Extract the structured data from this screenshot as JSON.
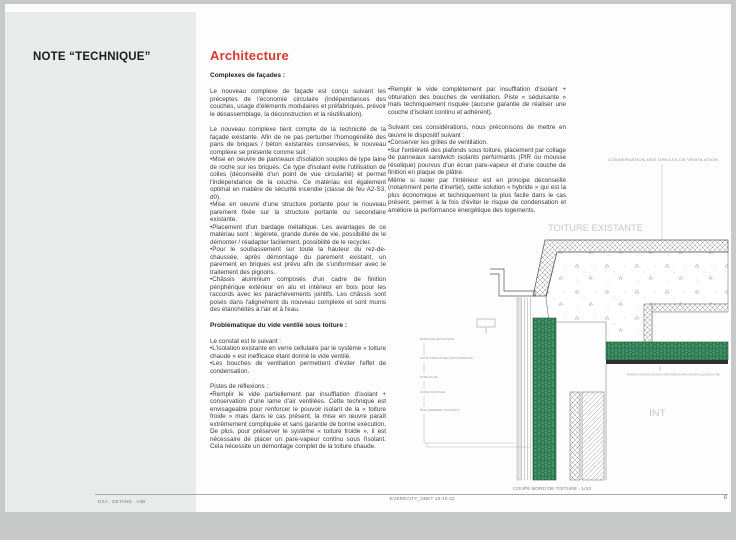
{
  "sidebar": {
    "title": "NOTE “TECHNIQUE”"
  },
  "article": {
    "heading": "Architecture",
    "col1": {
      "subhead1": "Complexes de façades :",
      "p1": "Le nouveau complexe de façade est conçu suivant les préceptes de l'économie circulaire (indépendances des couches, usage d'éléments modulaires et préfabriqués, prévoir le désassemblage, la déconstruction et la réutilisation).",
      "p2": "Le nouveau complexe tient compte de la technicité de la façade existante. Afin de ne pas perturber l'homogénéité des pans de briques / béton existantes conservées, le nouveau complexe se présente comme suit :",
      "b1": "•Mise en oeuvre de panneaux d'isolation souples de type laine de roche sur les briques. Ce type d'isolant évite l'utilisation de colles (déconseillé d'un point de vue circularité) et permet l'indépendance de la couche. Ce matériau est également optimal en matière de sécurité incendie (classe de feu A2-S3, d0).",
      "b2": "•Mise en oeuvre d'une structure portante pour le nouveau parement fixée sur la structure portante ou secondaire existante.",
      "b3": "•Placement d'un bardage métallique. Les avantages de ce matériau sont : légèreté, grande durée de vie, possibilité de le démonter / réadapter facilement, possibilité de le recycler.",
      "b4": "•Pour le soubassement sur toute la hauteur du rez-de-chaussée, après démontage du parement existant, un parement en briques est prévu afin de s'uniformiser avec le traitement des pignons.",
      "b5": "•Châssis aluminium composés d'un cadre de finition périphérique extérieur en alu et intérieur en bois pour les raccords avec les parachèvements jointifs. Les châssis sont posés dans l'alignement du nouveau complexe et sont munis des étanchéités à l'air et à l'eau.",
      "subhead2": "Problématique du vide ventilé sous toiture :",
      "p3": "Le constat est le suivant :",
      "b6": "•L'isolation existante en verre cellulaire par le système « toiture chaude » est inefficace étant donné le vide ventilé.",
      "b7": "•Les bouches de ventilation permettent d'éviter l'effet de condensation.",
      "p4": "Pistes de réflexions :",
      "b8": "•Remplir le vide partiellement par insufflation d'isolant + conservation d'une lame d'air ventilées. Cette technique est envisageable pour renforcer le pouvoir isolant de la « toiture froide » mais dans le cas présent, la mise en œuvre paraît extrêmement compliquée et sans garantie de bonne exécution. De plus, pour préserver le système « toiture froide », il est nécessaire de placer un pare-vapeur continu sous l'isolant. Cela nécessite un démontage complet de la toiture chaude."
    },
    "col2": {
      "b1": "•Remplir le vide complètement par insufflation d'isolant + obturation des bouches de ventilation. Piste « séduisante » mais techniquement risquée (aucune garantie de réaliser une couche d'isolant continu et adhérent).",
      "p1": "Suivant ces considérations, nous préconisons de mettre en œuvre le dispositif suivant :",
      "b2": "•Conserver les grilles de ventilation.",
      "b3": "•Sur l'entièreté des plafonds sous toiture, placement par collage de panneaux sandwich isolants performants (PIR ou mousse résolique) pourvus d'un écran pare-vapeur et d'une couche de finition en plaque de plâtre.",
      "p2": "Même si isoler par l'intérieur est en principe déconseillé (notamment perte d'inertie), cette solution « hybride » qui est la plus économique et techniquement la plus facile dans le cas présent, permet à la fois d'éviter le risque de condensation et améliore la performance énergétique des logements."
    }
  },
  "drawing": {
    "ventilation_note": "CONSERVATION DES GRILLES DE VENTILATION",
    "title": "TOITURE EXISTANTE",
    "interior_label": "INT",
    "layer_labels": [
      "BARDAGE METALLIQUE",
      "SOUS-STRUCTURE POUR BARDAGE",
      "PARE PLUIE",
      "LAINE DE ROCHE",
      "MUR PAREMENT EXISTANT"
    ],
    "panel_label": "PANNEAUX SANDWICH ISOLANTS PERFORMANTS+PARE-VAPEUR+PLAQUE DE PLATRE",
    "caption": "COUPE BORD DE TOITURE - 1/10",
    "scale": "1/10"
  },
  "footer": {
    "left": "DXA . DETANG . A3B",
    "center": "EVERECITY_GBET 18-10-22",
    "page": "6"
  },
  "colors": {
    "accent_red": "#d6392e",
    "panel_gray": "#e9eaea",
    "insulation_green": "#41946a",
    "drawing_gray_text": "#c8c8c8",
    "body_text": "#3b3b3b"
  }
}
